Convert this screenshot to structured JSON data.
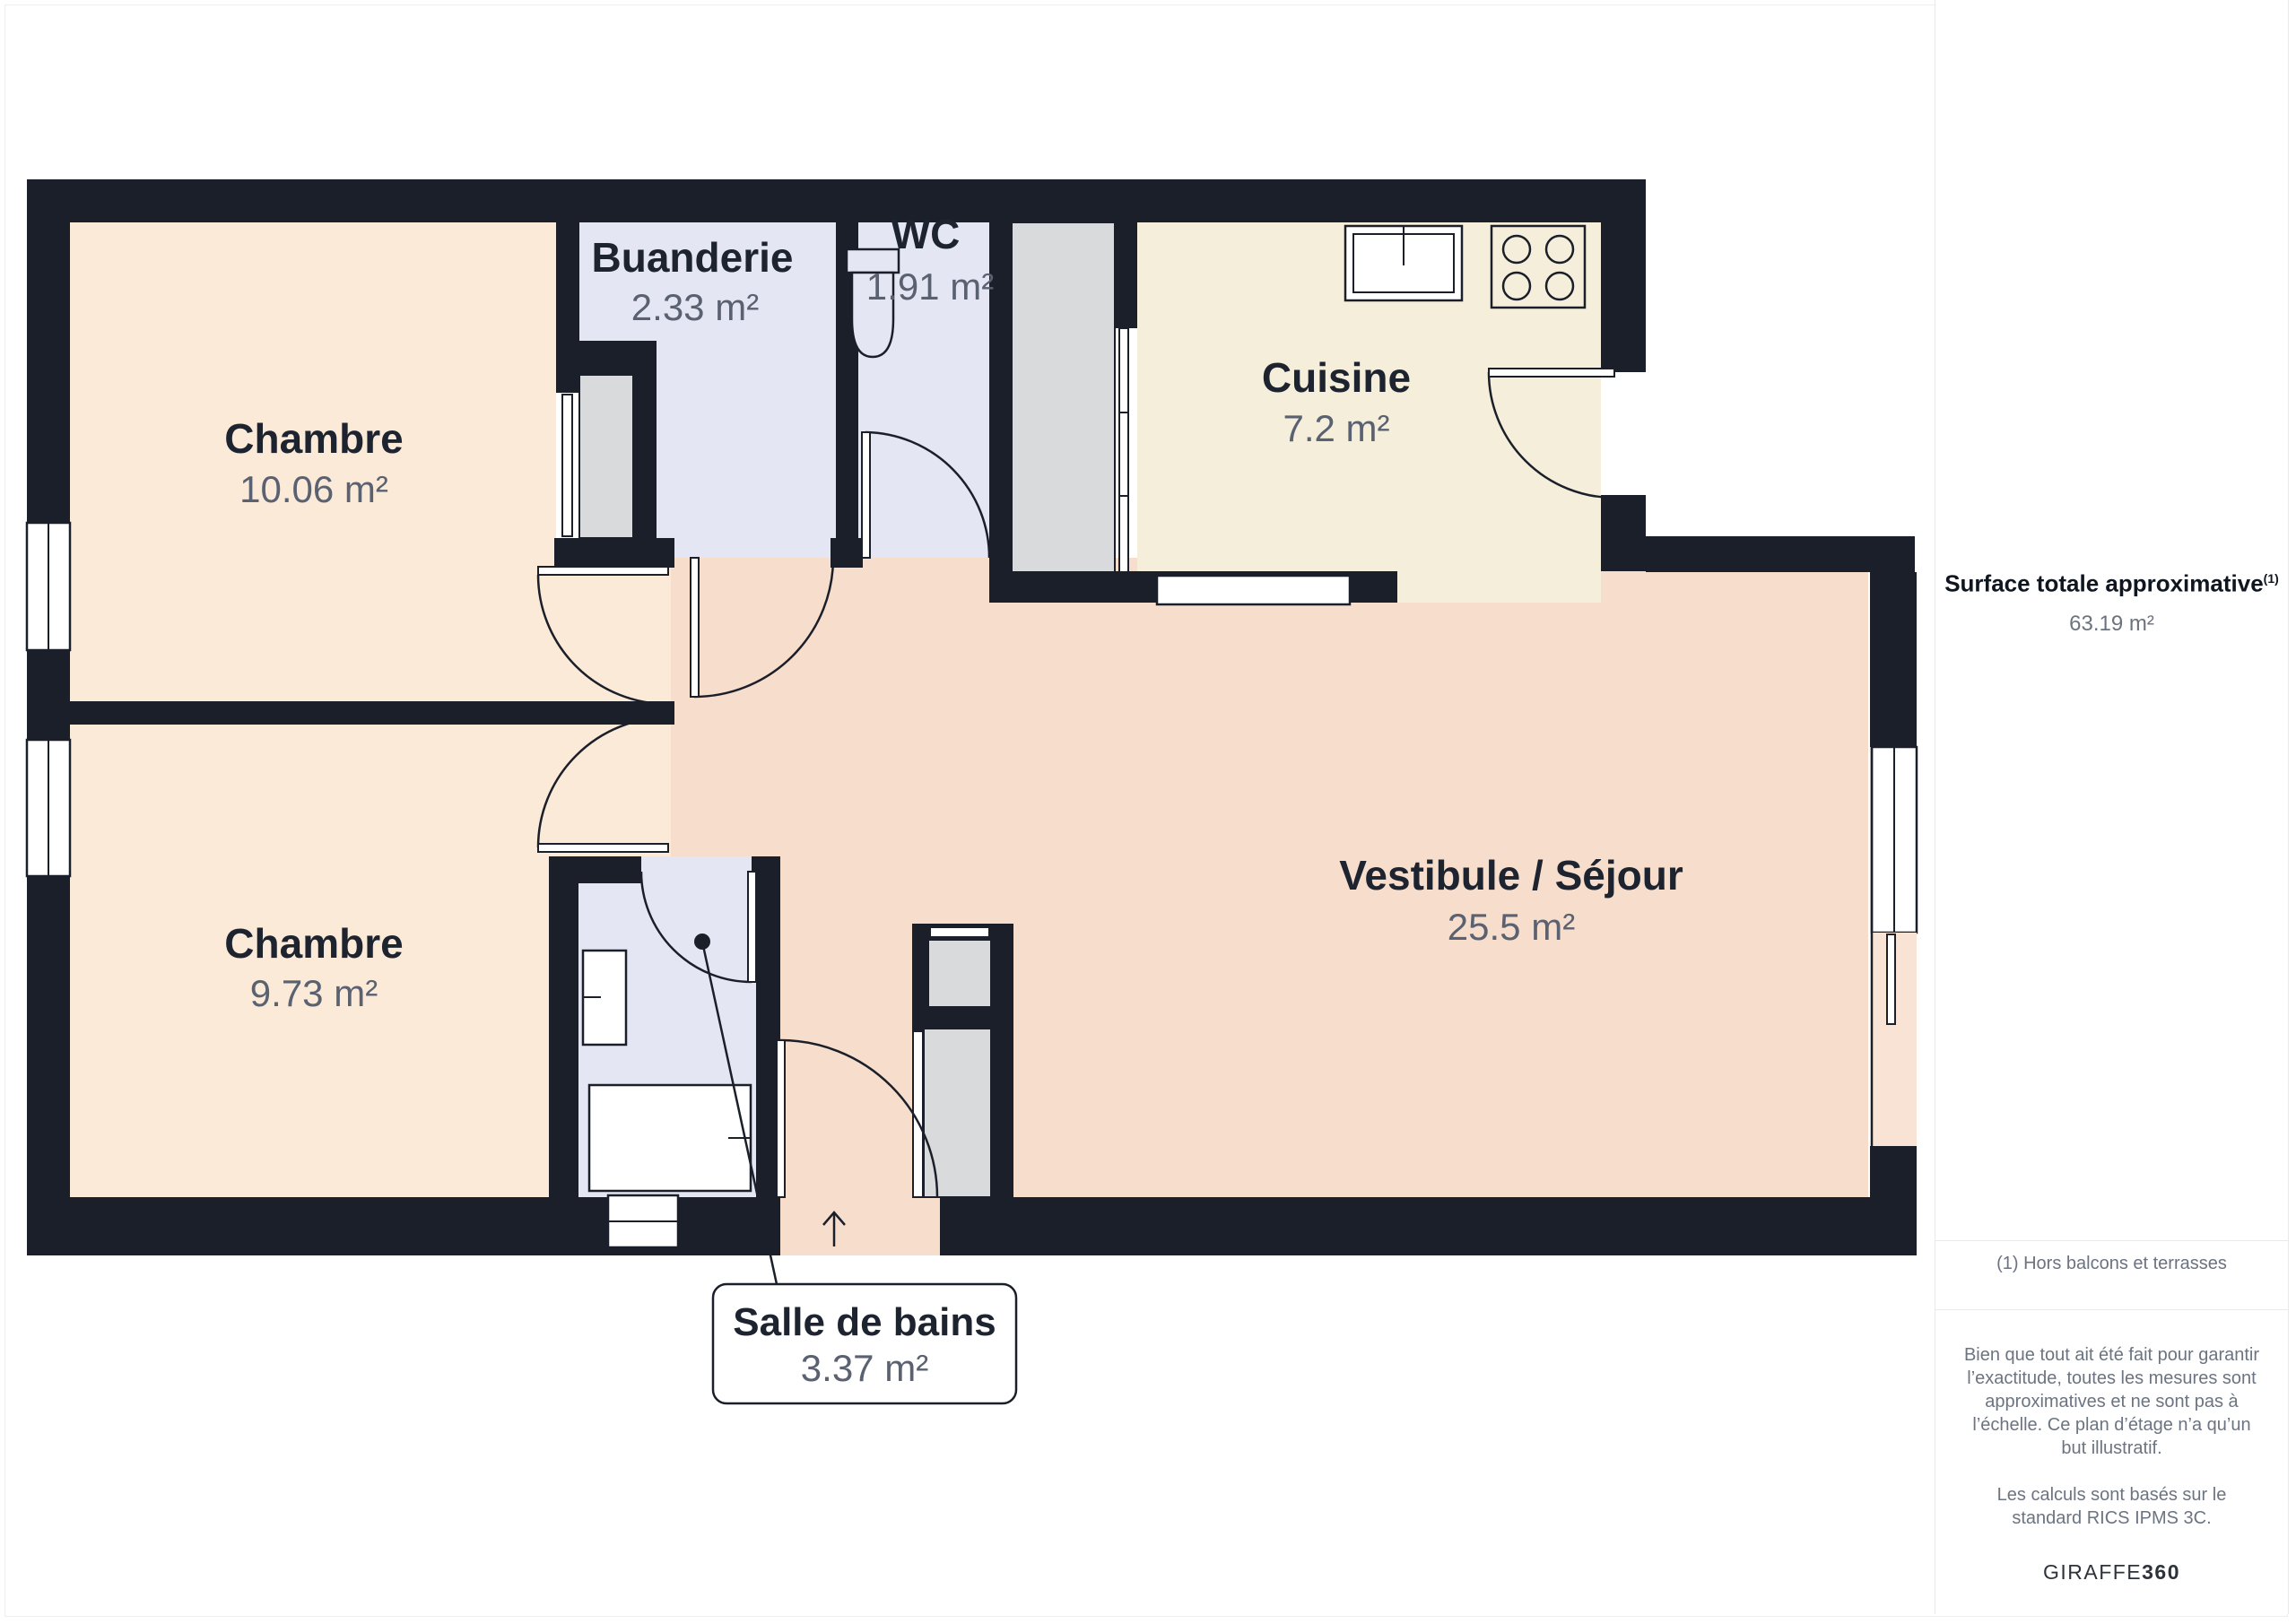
{
  "floor_plan": {
    "rooms": [
      {
        "id": "chambre-1",
        "name": "Chambre",
        "area": "10.06 m²"
      },
      {
        "id": "buanderie",
        "name": "Buanderie",
        "area": "2.33 m²"
      },
      {
        "id": "wc",
        "name": "WC",
        "area": "1.91 m²"
      },
      {
        "id": "cuisine",
        "name": "Cuisine",
        "area": "7.2 m²"
      },
      {
        "id": "vestibule-sejour",
        "name": "Vestibule / Séjour",
        "area": "25.5 m²"
      },
      {
        "id": "chambre-2",
        "name": "Chambre",
        "area": "9.73 m²"
      },
      {
        "id": "salle-de-bains",
        "name": "Salle de bains",
        "area": "3.37 m²"
      }
    ],
    "colors": {
      "wall": "#1a1f2a",
      "bedroom": "#fcead9",
      "utility": "#e4e7f3",
      "kitchen": "#f4eeda",
      "living": "#f7ddcc",
      "closet": "#d9dadb",
      "label_dark": "#1d2430",
      "label_grey": "#5a6170"
    }
  },
  "sidebar": {
    "title": "Surface totale approximative",
    "title_sup": "(1)",
    "total_area": "63.19 m²",
    "footnote": "(1) Hors balcons et terrasses",
    "disclaimer_1": "Bien que tout ait été fait pour garantir l’exactitude, toutes les mesures sont approximatives et ne sont pas à l’échelle. Ce plan d’étage n’a qu’un but illustratif.",
    "disclaimer_2": "Les calculs sont basés sur le standard RICS IPMS 3C.",
    "brand_name": "GIRAFFE",
    "brand_suffix": "360"
  }
}
